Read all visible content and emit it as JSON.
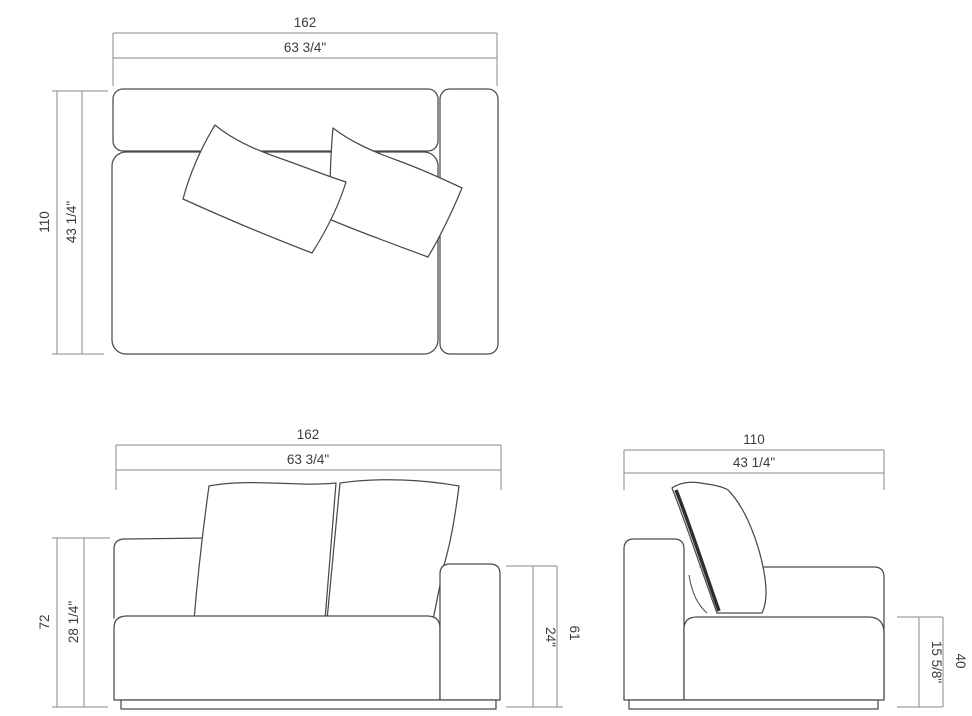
{
  "drawing": {
    "subject": "sofa-module-technical-drawing",
    "views": [
      "top-view",
      "front-view",
      "side-view"
    ]
  },
  "dimensions": {
    "top_view": {
      "width_cm": "162",
      "width_in": "63 3/4\"",
      "depth_cm": "110",
      "depth_in": "43 1/4\""
    },
    "front_view": {
      "width_cm": "162",
      "width_in": "63 3/4\"",
      "overall_height_cm": "72",
      "overall_height_in": "28 1/4\"",
      "arm_height_cm": "61",
      "arm_height_in": "24\""
    },
    "side_view": {
      "depth_cm": "110",
      "depth_in": "43 1/4\"",
      "seat_height_cm": "40",
      "seat_height_in": "15 5/8\""
    }
  },
  "colors": {
    "object_line": "#4a4a4a",
    "dimension_line": "#8a8a8a",
    "text": "#3c3c3c",
    "background": "#ffffff"
  }
}
